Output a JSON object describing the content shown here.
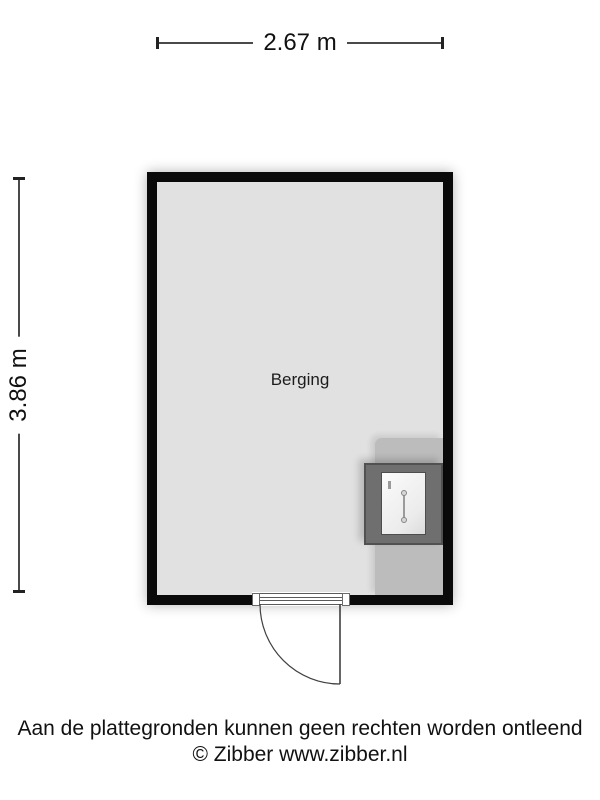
{
  "plan": {
    "room": {
      "label": "Berging"
    },
    "dimensions": {
      "width": "2.67 m",
      "height": "3.86 m"
    },
    "fixtures": {
      "boiler": "boiler-icon",
      "door": "door-swing-icon"
    },
    "colors": {
      "wall": "#0a0a0a",
      "floor": "#e1e1e1",
      "appliance_zone": "#bcbcbc",
      "boiler_frame": "#6f6f6f",
      "dimension_line": "#4a4a4a",
      "text": "#111111"
    }
  },
  "footer": {
    "disclaimer": "Aan de plattegronden kunnen geen rechten worden ontleend",
    "copyright": "© Zibber www.zibber.nl"
  }
}
